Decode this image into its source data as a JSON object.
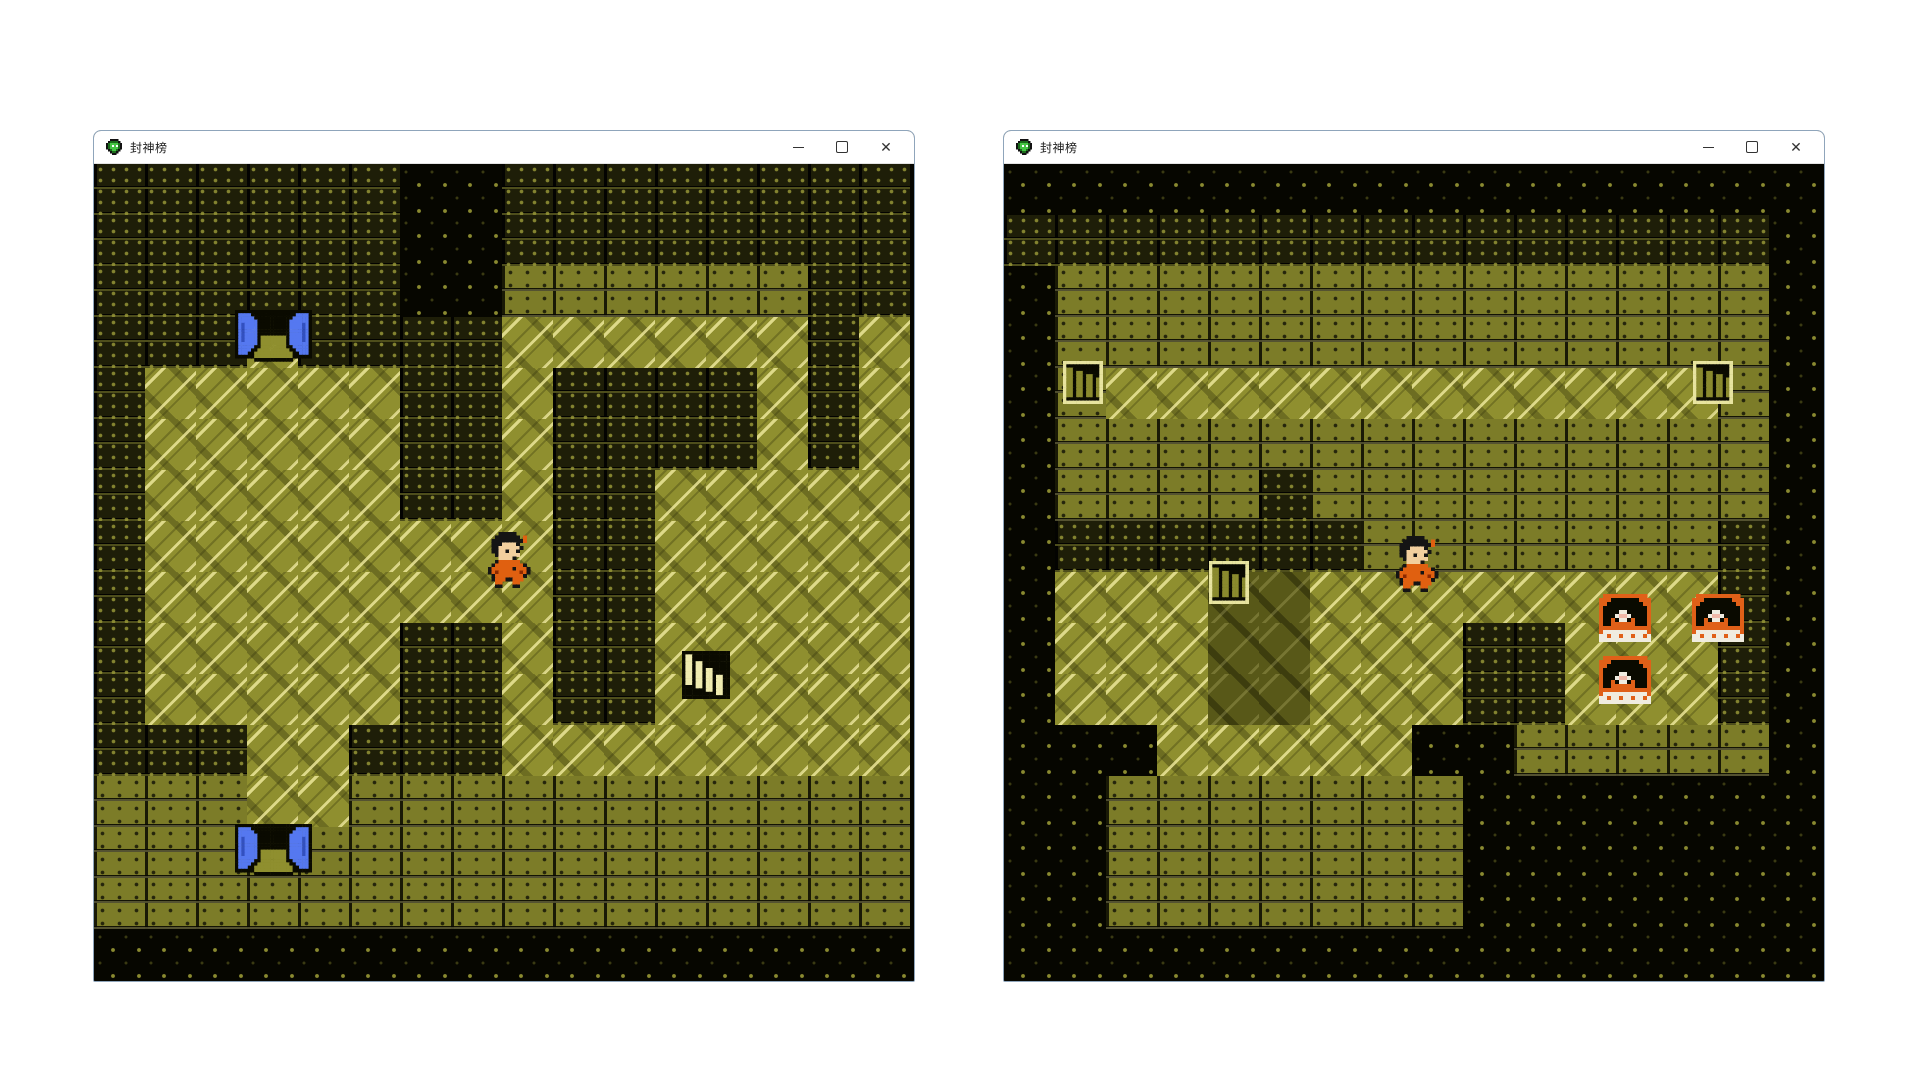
{
  "windows": [
    {
      "title": "封神榜",
      "x": 93,
      "y": 130,
      "width": 822,
      "height": 852,
      "controls": {
        "minimize": "─",
        "maximize": "□",
        "close": "✕"
      },
      "map": {
        "tile_size": 51,
        "cols": 16,
        "rows": 16,
        "tiles": [
          "KKKKKKVVKKKKKKKK",
          "KKKKKKVVKKKKKKKK",
          "KKKKKKVVBBBBBBKK",
          "KKKFKKKKFFFFFFKF",
          "KFFFFFKKFKKKKFKF",
          "KFFFFFKKFKKKKFKF",
          "KFFFFFKKFKKFFFFF",
          "KFFFFFFFFKKFFFFF",
          "KFFFFFFFFKKFFFFF",
          "KFFFFFKKFKKFFFFF",
          "KFFFFFKKFKKFFFFF",
          "KKKFFKKKFFFFFFFF",
          "BBBFFBBBBBBBBBBB",
          "BBBBBBBBBBBBBBBB",
          "BBBBBBBBBBBBBBBB",
          "VVVVVVVVVVVVVVVV"
        ],
        "objects": [
          {
            "type": "door",
            "name": "blue-door-top",
            "x": 141,
            "y": 146
          },
          {
            "type": "door",
            "name": "blue-door-bottom",
            "x": 141,
            "y": 660
          },
          {
            "type": "stairs_down",
            "name": "stairs-down",
            "x": 588,
            "y": 487
          },
          {
            "type": "player",
            "name": "player-sprite",
            "x": 394,
            "y": 368
          }
        ]
      }
    },
    {
      "title": "封神榜",
      "x": 1003,
      "y": 130,
      "width": 822,
      "height": 852,
      "controls": {
        "minimize": "─",
        "maximize": "□",
        "close": "✕"
      },
      "map": {
        "tile_size": 51,
        "cols": 16,
        "rows": 16,
        "tiles": [
          "VVVVVVVVVVVVVVVV",
          "KKKKKKKKKKKKKKKV",
          "VBBBBBBBBBBBBBBV",
          "VBBBBBBBBBBBBBBV",
          "VBFFFFFFFFFFFFBV",
          "VBBBBBBBBBBBBBBV",
          "VBBBBKBBBBBBBBBV",
          "VKKKKKKBBBBBBBKV",
          "VFFFGGFFFFFFFFKV",
          "VFFFGGFFFKKFFFKV",
          "VFFFGGFFFKKFFFKV",
          "VVVFFFFFVVBBBBBV",
          "VVBBBBBBBVVVVVVV",
          "VVBBBBBBBVVVVVVV",
          "VVBBBBBBBVVVVVVV",
          "VVVVVVVVVVVVVVVV"
        ],
        "objects": [
          {
            "type": "stairs_up",
            "name": "stairs-up-left",
            "x": 59,
            "y": 197
          },
          {
            "type": "stairs_up",
            "name": "stairs-up-right",
            "x": 689,
            "y": 197
          },
          {
            "type": "stairs_up",
            "name": "stairs-up-middle",
            "x": 205,
            "y": 397
          },
          {
            "type": "chest",
            "name": "treasure-chest-1",
            "x": 595,
            "y": 430
          },
          {
            "type": "chest",
            "name": "treasure-chest-2",
            "x": 688,
            "y": 430
          },
          {
            "type": "chest",
            "name": "treasure-chest-3",
            "x": 595,
            "y": 492
          },
          {
            "type": "player",
            "name": "player-sprite",
            "x": 392,
            "y": 372
          }
        ]
      }
    }
  ],
  "colors": {
    "floor": "#8f8f2f",
    "brick_light": "#7c7c28",
    "brick_dark": "#1e1e08",
    "void": "#060600",
    "door_blue": "#5578f0",
    "chest_orange": "#e06018",
    "robe_orange": "#e06010",
    "stair_cream": "#f0ecb0",
    "titlebar_bg": "#ffffff",
    "window_border": "#8fa5bb"
  }
}
